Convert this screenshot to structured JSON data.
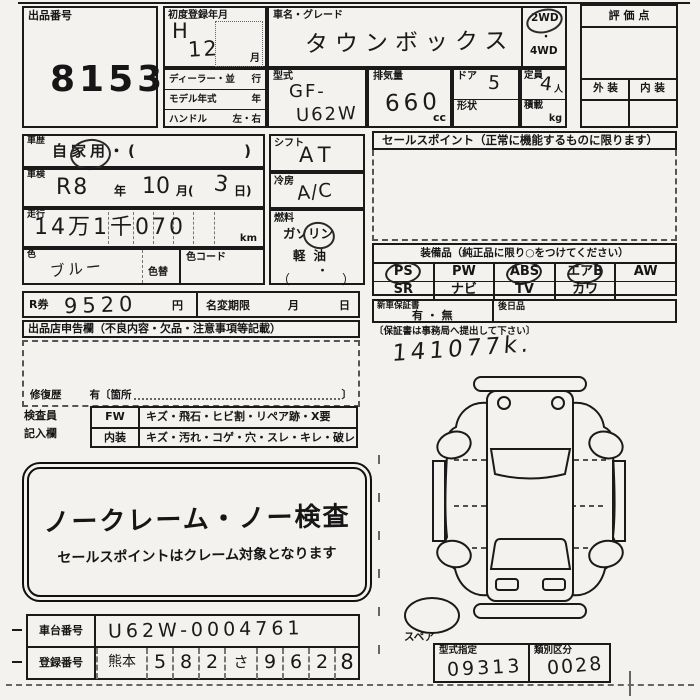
{
  "sheet": {
    "lot": {
      "label": "出品番号",
      "number": "8153"
    },
    "first_registration": {
      "label": "初度登録年月",
      "era": "H",
      "year": "12",
      "month_suffix": "月"
    },
    "vehicle": {
      "label": "車名・グレード",
      "name": "タウンボックス"
    },
    "drive": {
      "top": "2WD",
      "sep": "・",
      "bottom": "4WD",
      "circled": "2WD"
    },
    "rating": {
      "title": "評 価 点",
      "exterior": "外 装",
      "interior": "内 装"
    },
    "dealer_rows": [
      {
        "label": "ディーラー・並",
        "unit": "行"
      },
      {
        "label": "モデル年式",
        "unit": "年"
      },
      {
        "label": "ハンドル",
        "unit": "左・右"
      }
    ],
    "model_code": {
      "label": "型式",
      "line1": "GF-",
      "line2": "U62W"
    },
    "displacement": {
      "label": "排気量",
      "value": "660",
      "unit": "cc"
    },
    "doors": {
      "label": "ドア",
      "value": "5"
    },
    "body_shape": {
      "label": "形状"
    },
    "capacity": {
      "label": "定員",
      "value": "4",
      "unit": "人"
    },
    "payload": {
      "label": "積載",
      "unit": "kg"
    },
    "history": {
      "label": "車歴",
      "value": "自家用・(",
      "close": ")",
      "circled": "自家用"
    },
    "shaken": {
      "label": "車検",
      "era": "R8",
      "year_suffix": "年",
      "month": "10",
      "month_suffix": "月(",
      "day": "3",
      "day_suffix": "日)"
    },
    "mileage": {
      "label": "走行",
      "value": "14万1千070",
      "unit": "km"
    },
    "color": {
      "label": "色",
      "value": "ブルー",
      "change_label": "色替",
      "code_label": "色コード"
    },
    "shift": {
      "label": "シフト",
      "value": "AT"
    },
    "aircon": {
      "label": "冷房",
      "value": "A/C"
    },
    "fuel": {
      "label": "燃料",
      "gasoline": "ガソリン",
      "diesel": "軽油",
      "dot": "・",
      "open": "（",
      "close": "）",
      "circled": "ガソリン"
    },
    "sales_point": {
      "title": "セールスポイント（正常に機能するものに限ります）"
    },
    "equipment": {
      "title": "装備品（純正品に限り○をつけてください）",
      "row1": [
        "PS",
        "PW",
        "ABS",
        "エアB",
        "AW"
      ],
      "row2": [
        "SR",
        "ナビ",
        "TV",
        "カワ",
        ""
      ],
      "circled": [
        "PS",
        "ABS",
        "エアB"
      ]
    },
    "r_ticket": {
      "label": "R券",
      "value": "9520",
      "unit": "円"
    },
    "name_change": {
      "label": "名変期限",
      "month": "月",
      "day": "日"
    },
    "warranty": {
      "label": "新車保証書",
      "options": "有 ・ 無",
      "later": "後日品",
      "note": "〔保証書は事務局へ提出して下さい〕"
    },
    "odometer_note": "141077k.",
    "declaration": {
      "title": "出品店申告欄（不良内容・欠品・注意事項等記載）",
      "repair_label": "修復歴",
      "repair_text": "有〔箇所",
      "repair_close": "〕"
    },
    "inspector": {
      "label1": "検査員",
      "label2": "記入欄",
      "rows": [
        {
          "head": "FW",
          "text": "キズ・飛石・ヒビ割・リペア跡・X要"
        },
        {
          "head": "内装",
          "text": "キズ・汚れ・コゲ・穴・スレ・キレ・破レ"
        }
      ]
    },
    "no_claim": {
      "title": "ノークレーム・ノー検査",
      "subtitle": "セールスポイントはクレーム対象となります"
    },
    "chassis": {
      "label": "車台番号",
      "value": "U62W-0004761"
    },
    "registration": {
      "label": "登録番号",
      "cells": [
        "熊本",
        "5",
        "8",
        "2",
        "さ",
        "9",
        "6",
        "2",
        "8"
      ]
    },
    "spare": {
      "label": "スペア"
    },
    "type_designation": {
      "label": "型式指定",
      "value": "09313"
    },
    "class_category": {
      "label": "類別区分",
      "value": "0028"
    }
  }
}
